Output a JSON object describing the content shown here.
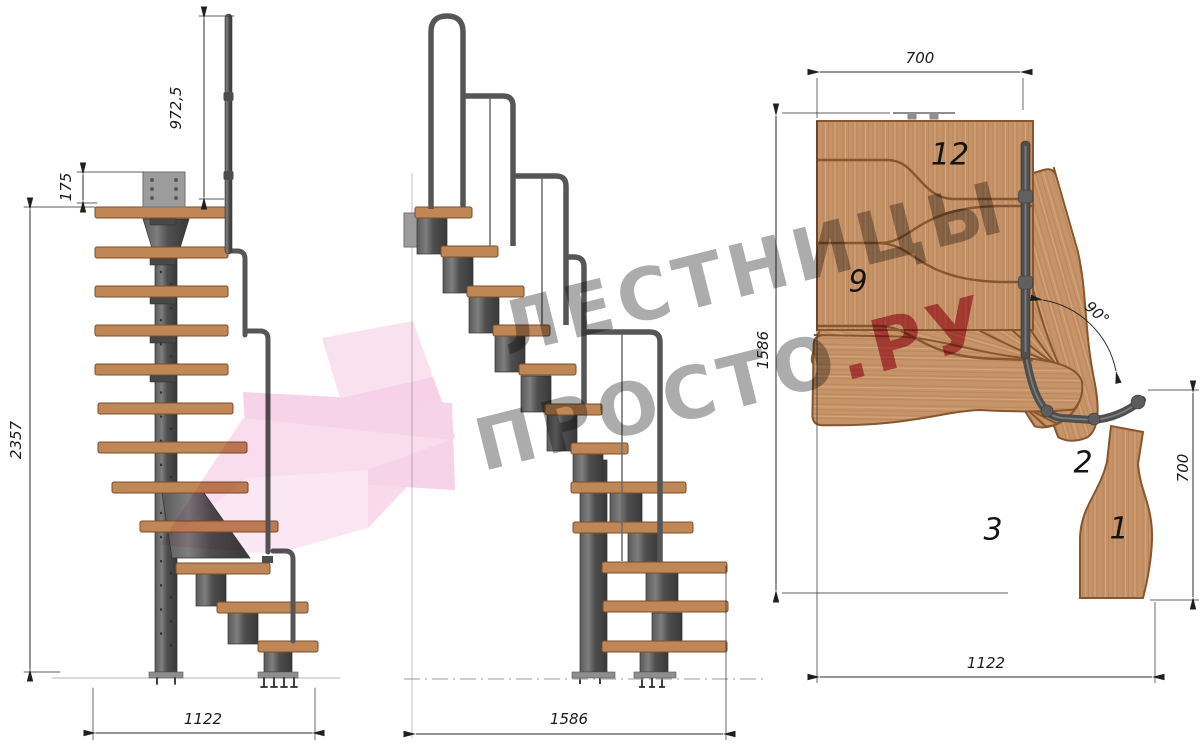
{
  "watermark": {
    "line1": "ЛЕСТНИЦЫ",
    "line2_gray": "ПРОСТО",
    "line2_red": ".РУ"
  },
  "side_view": {
    "rail_height": "972,5",
    "plate_height": "175",
    "total_height": "2357",
    "total_width": "1122"
  },
  "front_view": {
    "total_width": "1586"
  },
  "plan_view": {
    "top_width": "700",
    "left_depth": "1586",
    "turn_angle": "90°",
    "right_depth": "700",
    "bottom_width": "1122",
    "step_numbers": [
      "12",
      "9",
      "2",
      "3",
      "1"
    ]
  },
  "colors": {
    "wood": "#c69268",
    "metal": "#4e4e4e",
    "dimension_lines": "#2b2b2b",
    "watermark_gray": "#9a9a9a",
    "watermark_red": "#c8445c",
    "watermark_pink": "#f0aed8"
  }
}
